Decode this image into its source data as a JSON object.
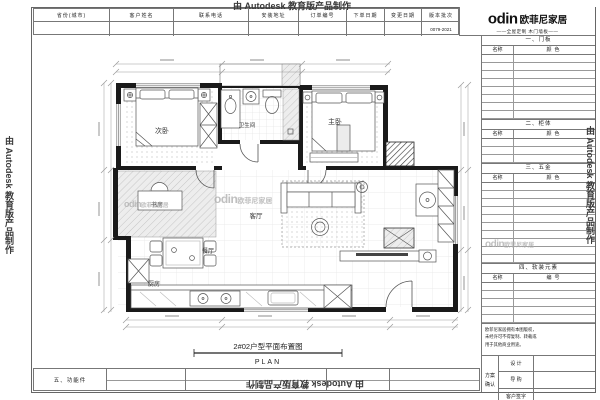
{
  "watermarks": {
    "autodesk": "由 Autodesk 教育版产品制作"
  },
  "logo": {
    "brand": "odin",
    "company": "欧菲尼家居",
    "tagline": "——全屋定制 木门墙板——"
  },
  "header": {
    "fields": [
      {
        "label": "省份(城市)",
        "value": ""
      },
      {
        "label": "客户姓名",
        "value": ""
      },
      {
        "label": "联系电话",
        "value": ""
      },
      {
        "label": "安装地址",
        "value": ""
      },
      {
        "label": "订单编号",
        "value": ""
      },
      {
        "label": "下单日期",
        "value": ""
      },
      {
        "label": "变更日期",
        "value": ""
      },
      {
        "label": "版本批次",
        "value": "0079-2021"
      }
    ]
  },
  "sidebar": {
    "sections": [
      {
        "title": "一、门板",
        "col1": "名称",
        "col2": "颜色"
      },
      {
        "title": "二、柜体",
        "col1": "名称",
        "col2": "颜色"
      },
      {
        "title": "三、五金",
        "col1": "名称",
        "col2": "颜色"
      },
      {
        "title": "四、软装元素",
        "col1": "名称",
        "col2": "编号"
      }
    ],
    "notice_lines": [
      "欧菲尼家居拥有本图版权，",
      "未经许可不得复制、转载或",
      "用于其他商业用途。"
    ],
    "confirm": {
      "label_line1": "方案",
      "label_line2": "确认",
      "rows": [
        "设 计",
        "导 购",
        "客户签字"
      ]
    }
  },
  "plan": {
    "rooms": {
      "secondary": "次卧",
      "bathroom": "卫生间",
      "master": "主卧",
      "study": "书房",
      "living": "客厅",
      "dining": "餐厅",
      "kitchen": "厨房"
    },
    "title": "2#02户型平面布置图",
    "subtitle": "PLAN"
  },
  "bottom_strip": {
    "label": "五、功能件"
  }
}
